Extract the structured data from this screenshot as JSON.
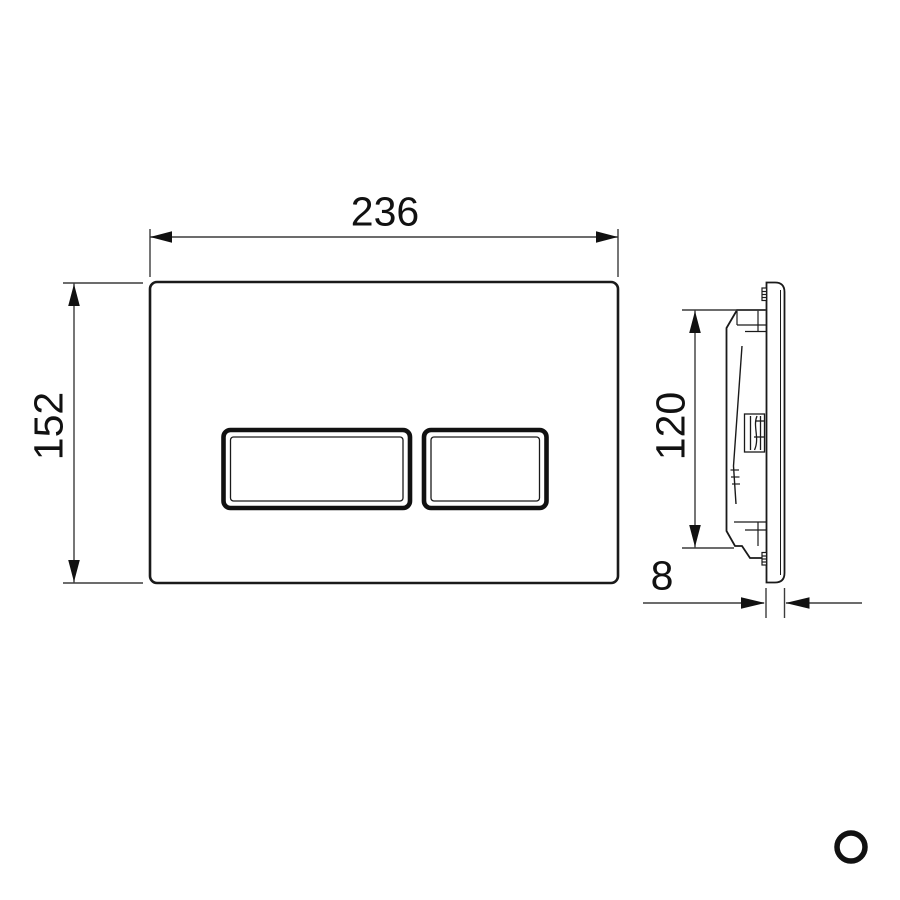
{
  "drawing": {
    "type": "technical-dimension-drawing",
    "subject": "dual-flush wall plate with two rectangular buttons, front view and side profile view",
    "views": {
      "front_view": "flush plate face with large and small flush buttons",
      "side_view": "plate profile with mounting housing"
    },
    "dimension_labels": {
      "width": "236",
      "height": "152",
      "housing_height": "120",
      "thickness": "8"
    }
  },
  "colors": {
    "background": "#ffffff",
    "outline": "#1a1a1a",
    "dimension_line": "#3c3c3c",
    "text": "#111111"
  }
}
